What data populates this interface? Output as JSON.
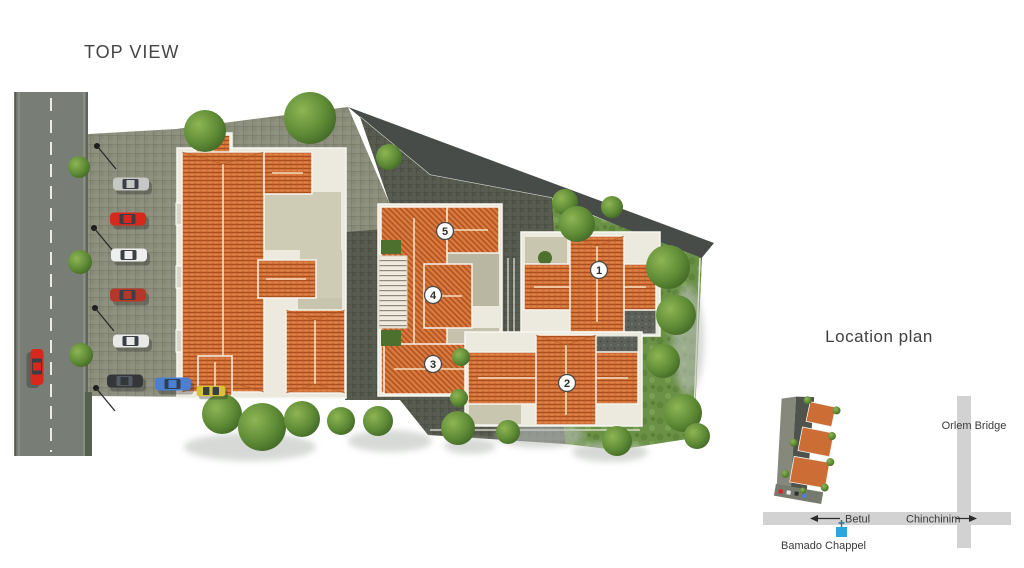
{
  "top_view": {
    "title": "TOP VIEW",
    "building_markers": [
      {
        "label": "1"
      },
      {
        "label": "2"
      },
      {
        "label": "3"
      },
      {
        "label": "4"
      },
      {
        "label": "5"
      }
    ],
    "cars": [
      {
        "name": "silver-car",
        "color": "#c7c7c5"
      },
      {
        "name": "red-car",
        "color": "#d6281c"
      },
      {
        "name": "white-car",
        "color": "#efefed"
      },
      {
        "name": "dark-red-car",
        "color": "#b5372a"
      },
      {
        "name": "white-car-2",
        "color": "#e9e9e7"
      },
      {
        "name": "black-car",
        "color": "#34373a"
      },
      {
        "name": "blue-car",
        "color": "#4d7fd0"
      },
      {
        "name": "yellow-van",
        "color": "#d9c238"
      },
      {
        "name": "road-red-car",
        "color": "#d6281c"
      }
    ],
    "colors": {
      "roof_orange": "#d3723a",
      "lawn_green": "#6b9147",
      "road_gray": "#787d76",
      "pavers_light": "#8c8e7e",
      "pavers_dark": "#575b50",
      "asphalt": "#474c49",
      "terrace_beige": "#cfccb6"
    }
  },
  "location_plan": {
    "title": "Location plan",
    "road_west": "Betul",
    "road_east": "Chinchinim",
    "road_north": "Orlem Bridge",
    "landmark": "Bamado Chappel",
    "landmark_color": "#2ba7e0",
    "road_color": "#d2d2d2"
  }
}
